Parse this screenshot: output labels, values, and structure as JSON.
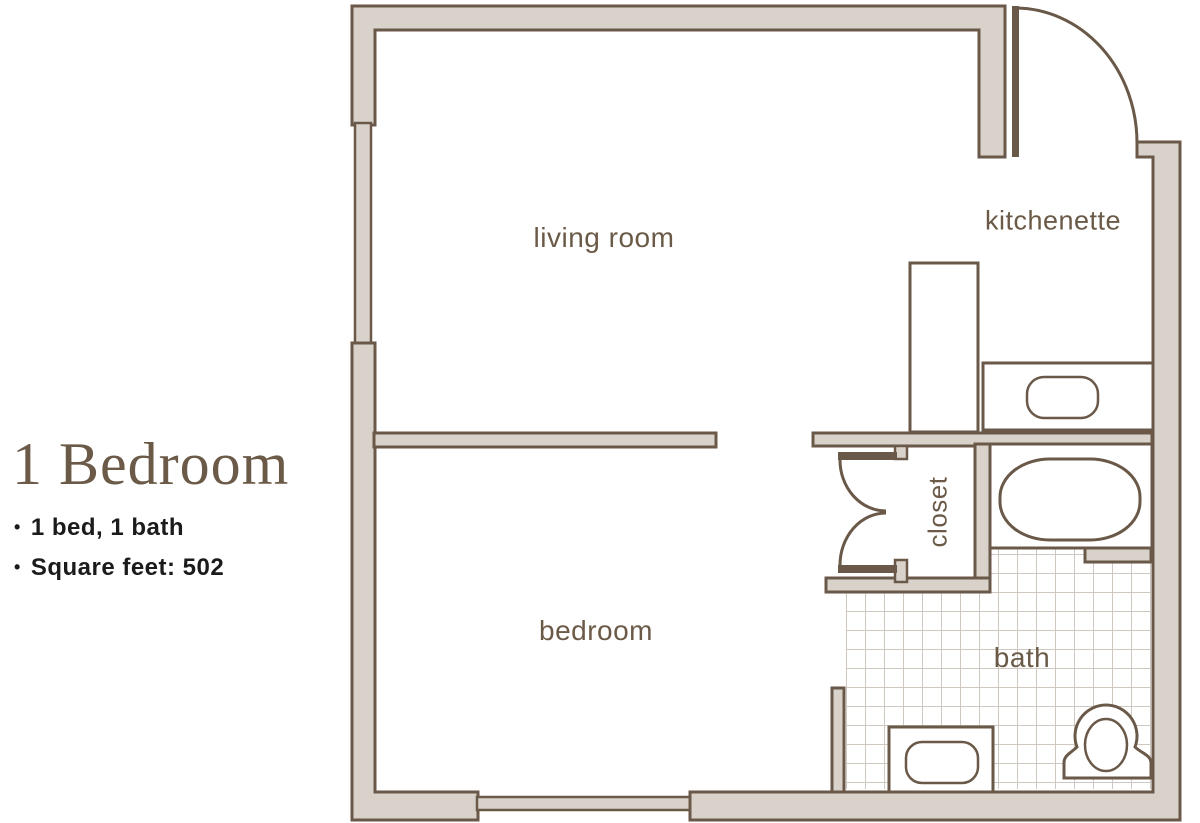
{
  "info_panel": {
    "title": "1 Bedroom",
    "bullet_char": "•",
    "details": [
      {
        "label": "1 bed, 1 bath"
      },
      {
        "label": "Square feet: 502"
      }
    ]
  },
  "floorplan": {
    "rooms": {
      "living_room": "living room",
      "kitchenette": "kitchenette",
      "closet": "closet",
      "bath": "bath",
      "bedroom": "bedroom"
    },
    "colors": {
      "wall_fill": "#d9d2ca",
      "wall_stroke": "#6a5948",
      "label_text": "#6b5a47",
      "tile_line": "#cfc8c0",
      "detail_text": "#1b1b1b"
    }
  }
}
